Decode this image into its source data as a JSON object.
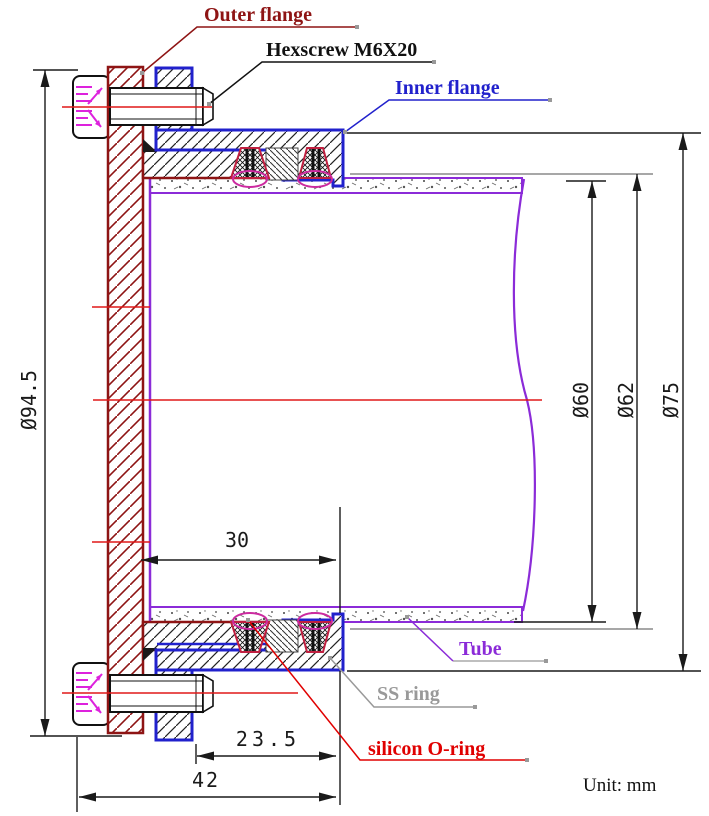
{
  "drawing": {
    "type": "engineering-cross-section-flange-assembly",
    "unit_note": "Unit: mm",
    "labels": {
      "outer_flange": "Outer flange",
      "hexscrew": "Hexscrew M6X20",
      "inner_flange": "Inner flange",
      "tube": "Tube",
      "ss_ring": "SS ring",
      "silicon_o_ring": "silicon O-ring"
    },
    "dimensions": {
      "flange_od": "Ø94.5",
      "dia_75": "Ø75",
      "dia_62": "Ø62",
      "dia_60": "Ø60",
      "len_30": "30",
      "len_23_5": "23.5",
      "len_42": "42"
    },
    "colors": {
      "outer_flange": "#8E1414",
      "inner_flange": "#2121CC",
      "tube": "#8B2BD8",
      "centerline": "#E01818",
      "o_ring_label": "#E00000",
      "o_ring_outline": "#C02040",
      "o_ring_ellipse": "#CC2AA0",
      "ss_ring_label": "#999999",
      "thread_marks": "#DD22DD",
      "dimension": "#1A1A1A"
    }
  }
}
